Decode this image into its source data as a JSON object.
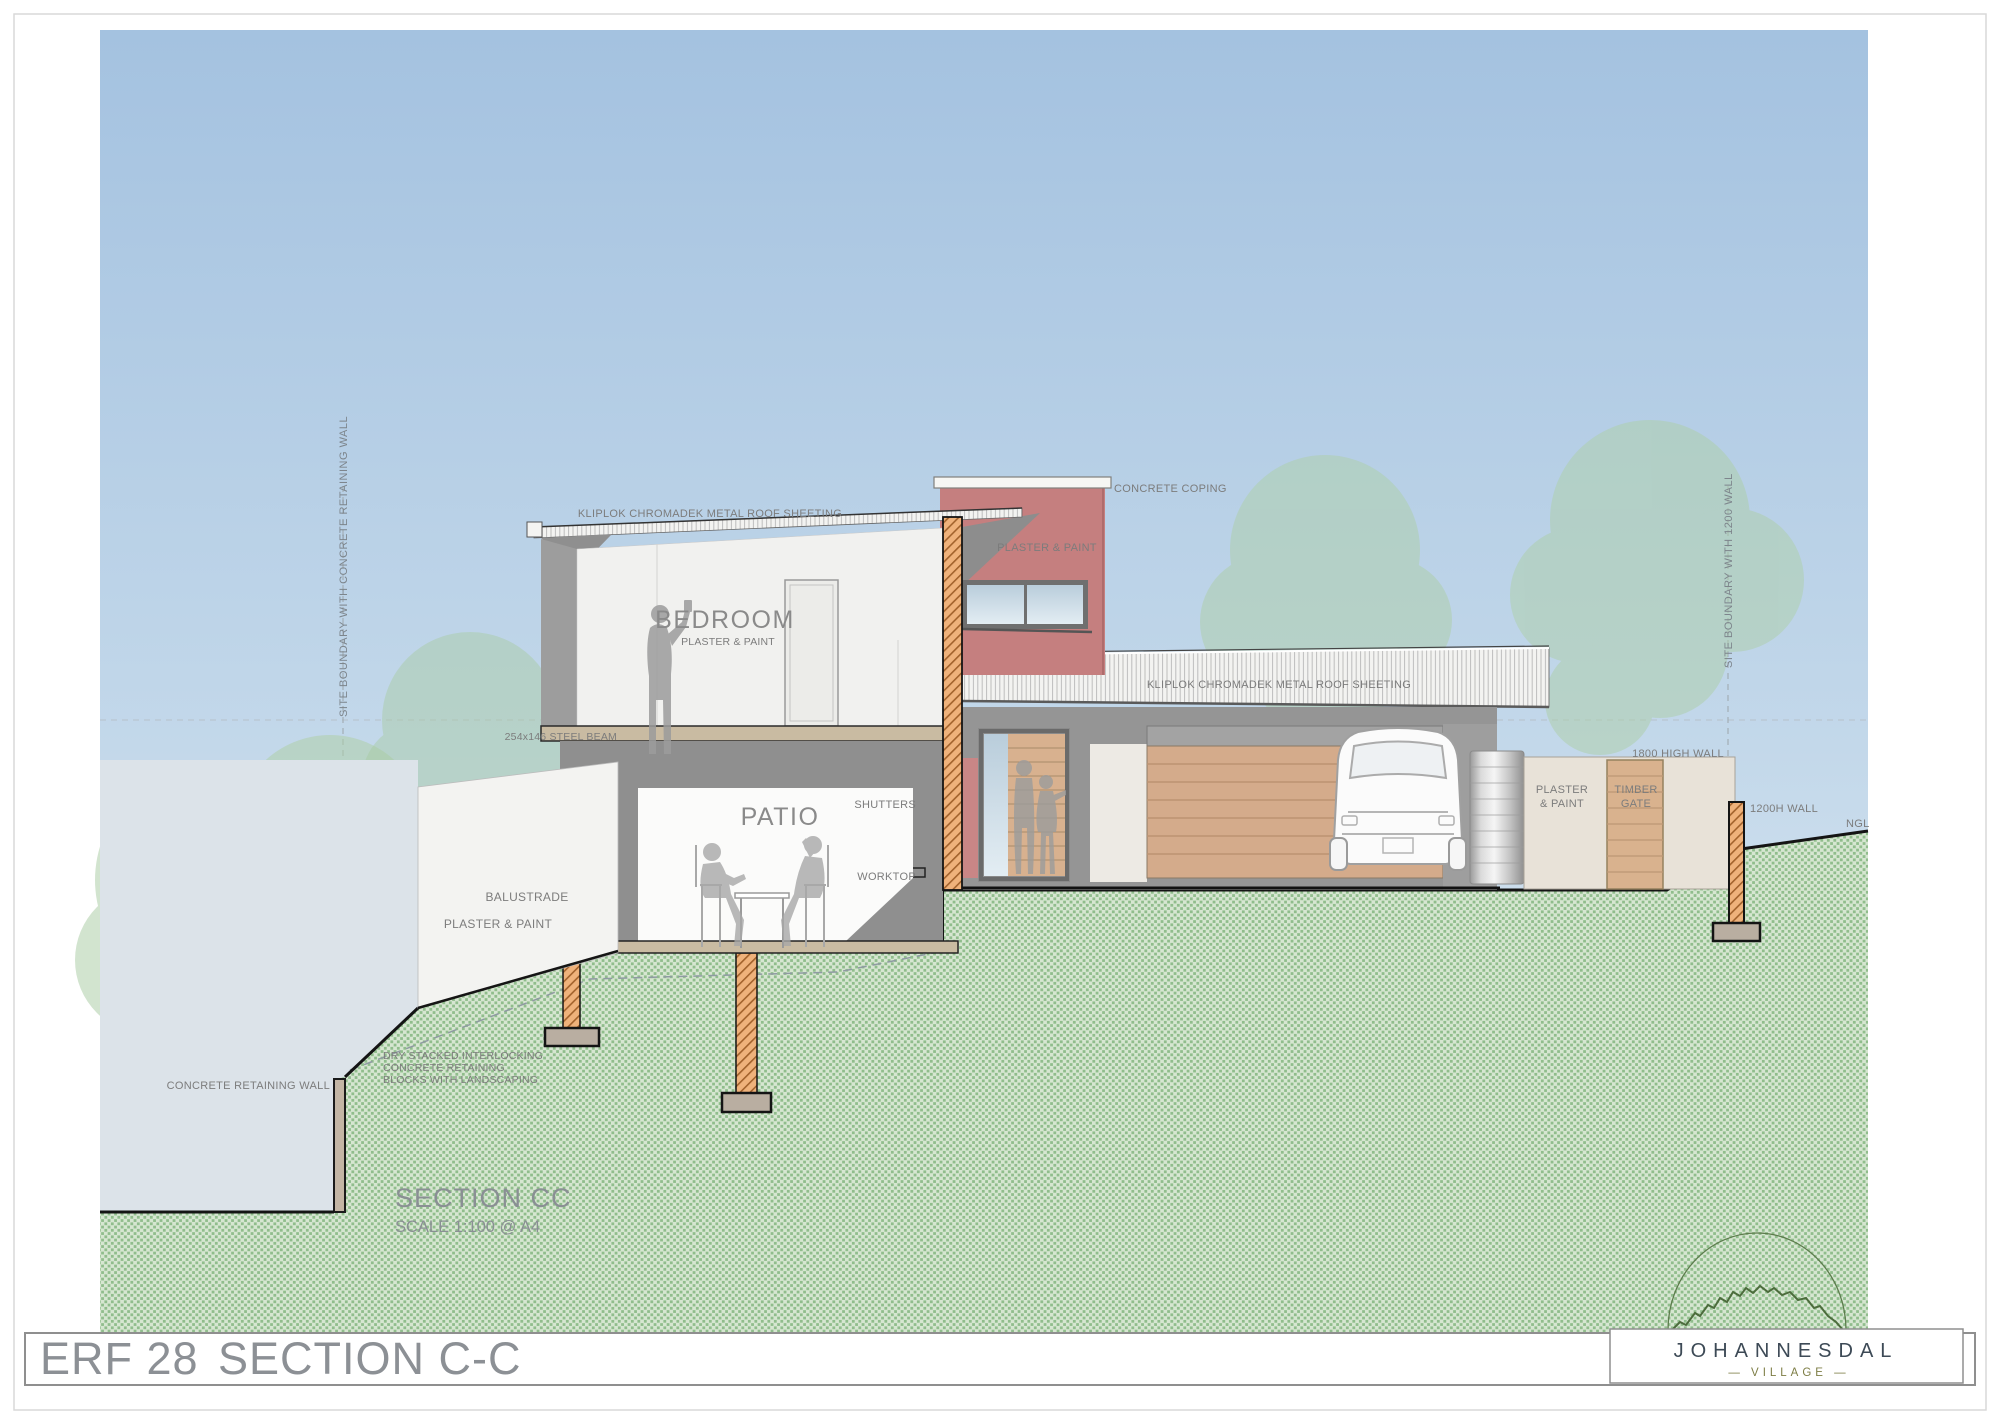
{
  "title_block": {
    "erf_label": "ERF 28",
    "drawing_title": "SECTION C-C"
  },
  "drawing_caption": {
    "title": "SECTION CC",
    "scale": "SCALE 1:100 @ A4"
  },
  "logo": {
    "name": "JOHANNESDAL",
    "subtitle": "— VILLAGE —"
  },
  "labels": {
    "roof_sheeting_upper": "KLIPLOK CHROMADEK METAL ROOF SHEETING",
    "roof_sheeting_lower": "KLIPLOK CHROMADEK METAL ROOF SHEETING",
    "concrete_coping": "CONCRETE COPING",
    "tower_finish": "PLASTER & PAINT",
    "bedroom": "BEDROOM",
    "bedroom_finish": "PLASTER & PAINT",
    "steel_beam": "254x146 STEEL BEAM",
    "shutters": "SHUTTERS",
    "patio": "PATIO",
    "worktop": "WORKTOP",
    "balustrade": "BALUSTRADE",
    "balustrade_finish": "PLASTER & PAINT",
    "high_wall": "1800 HIGH WALL",
    "wall_finish_1": "PLASTER",
    "wall_finish_2": "& PAINT",
    "timber_gate_1": "TIMBER",
    "timber_gate_2": "GATE",
    "low_wall": "1200H WALL",
    "ngl": "NGL",
    "retaining_wall": "CONCRETE RETAINING WALL",
    "dry_stacked_1": "DRY STACKED INTERLOCKING",
    "dry_stacked_2": "CONCRETE RETAINING",
    "dry_stacked_3": "BLOCKS WITH LANDSCAPING",
    "boundary_left": "SITE BOUNDARY WITH CONCRETE RETAINING WALL",
    "boundary_right": "SITE BOUNDARY WITH 1200 WALL"
  },
  "colors": {
    "sky_top": "#a4c2e0",
    "sky_bottom": "#dbe9f2",
    "ground_base": "#d6e6d1",
    "ground_stipple": "#90bd8c",
    "accent_red": "#c57f7f",
    "timber": "#d4ab8b",
    "hatch_fill": "#efb27b",
    "wall_gray": "#959595",
    "label_gray": "#7c7c7c",
    "logo_navy": "#3d4a56",
    "logo_olive": "#7d7d45"
  }
}
